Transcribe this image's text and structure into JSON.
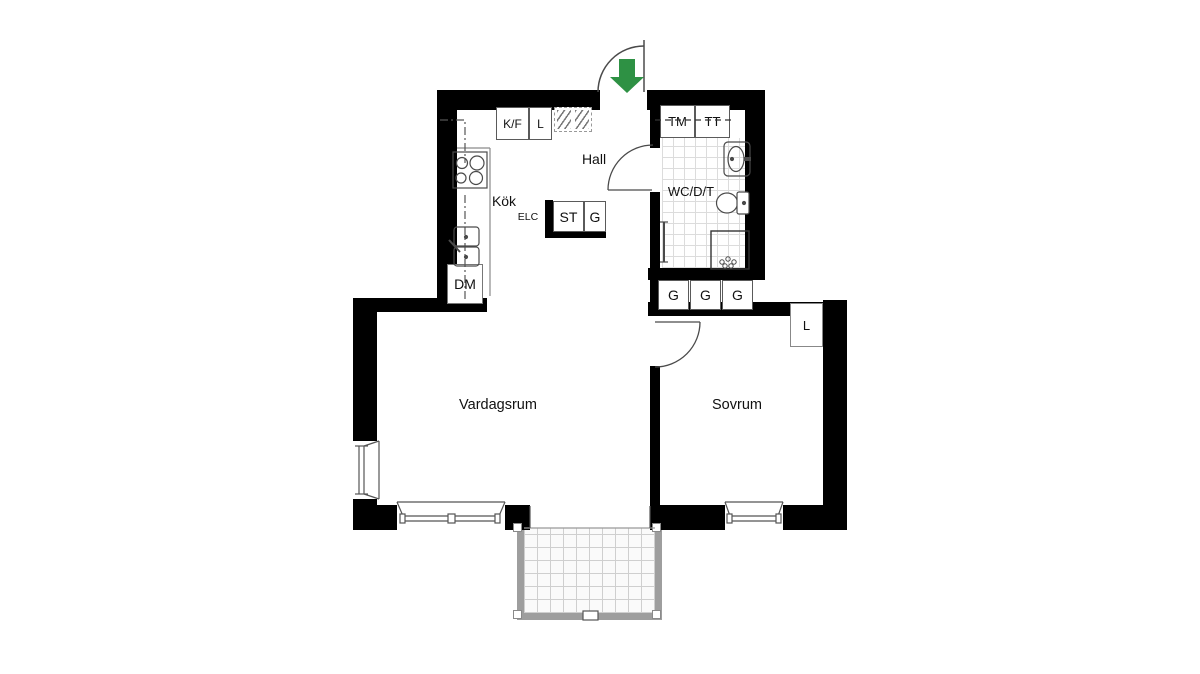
{
  "title": "Apartment floor plan",
  "entrance": {
    "arrow_color": "#2e9144"
  },
  "rooms": {
    "hall": "Hall",
    "kitchen": "Kök",
    "living_room": "Vardagsrum",
    "bedroom": "Sovrum",
    "bathroom": "WC/D/T"
  },
  "labels": {
    "fridge_freezer": "K/F",
    "kitchen_closet": "L",
    "electrical": "ELC",
    "hall_closet_st": "ST",
    "hall_closet_g": "G",
    "dishwasher": "DM",
    "washing_machine": "TM",
    "tumble_dryer": "TT",
    "wardrobes": [
      "G",
      "G",
      "G"
    ],
    "bedroom_closet": "L"
  }
}
